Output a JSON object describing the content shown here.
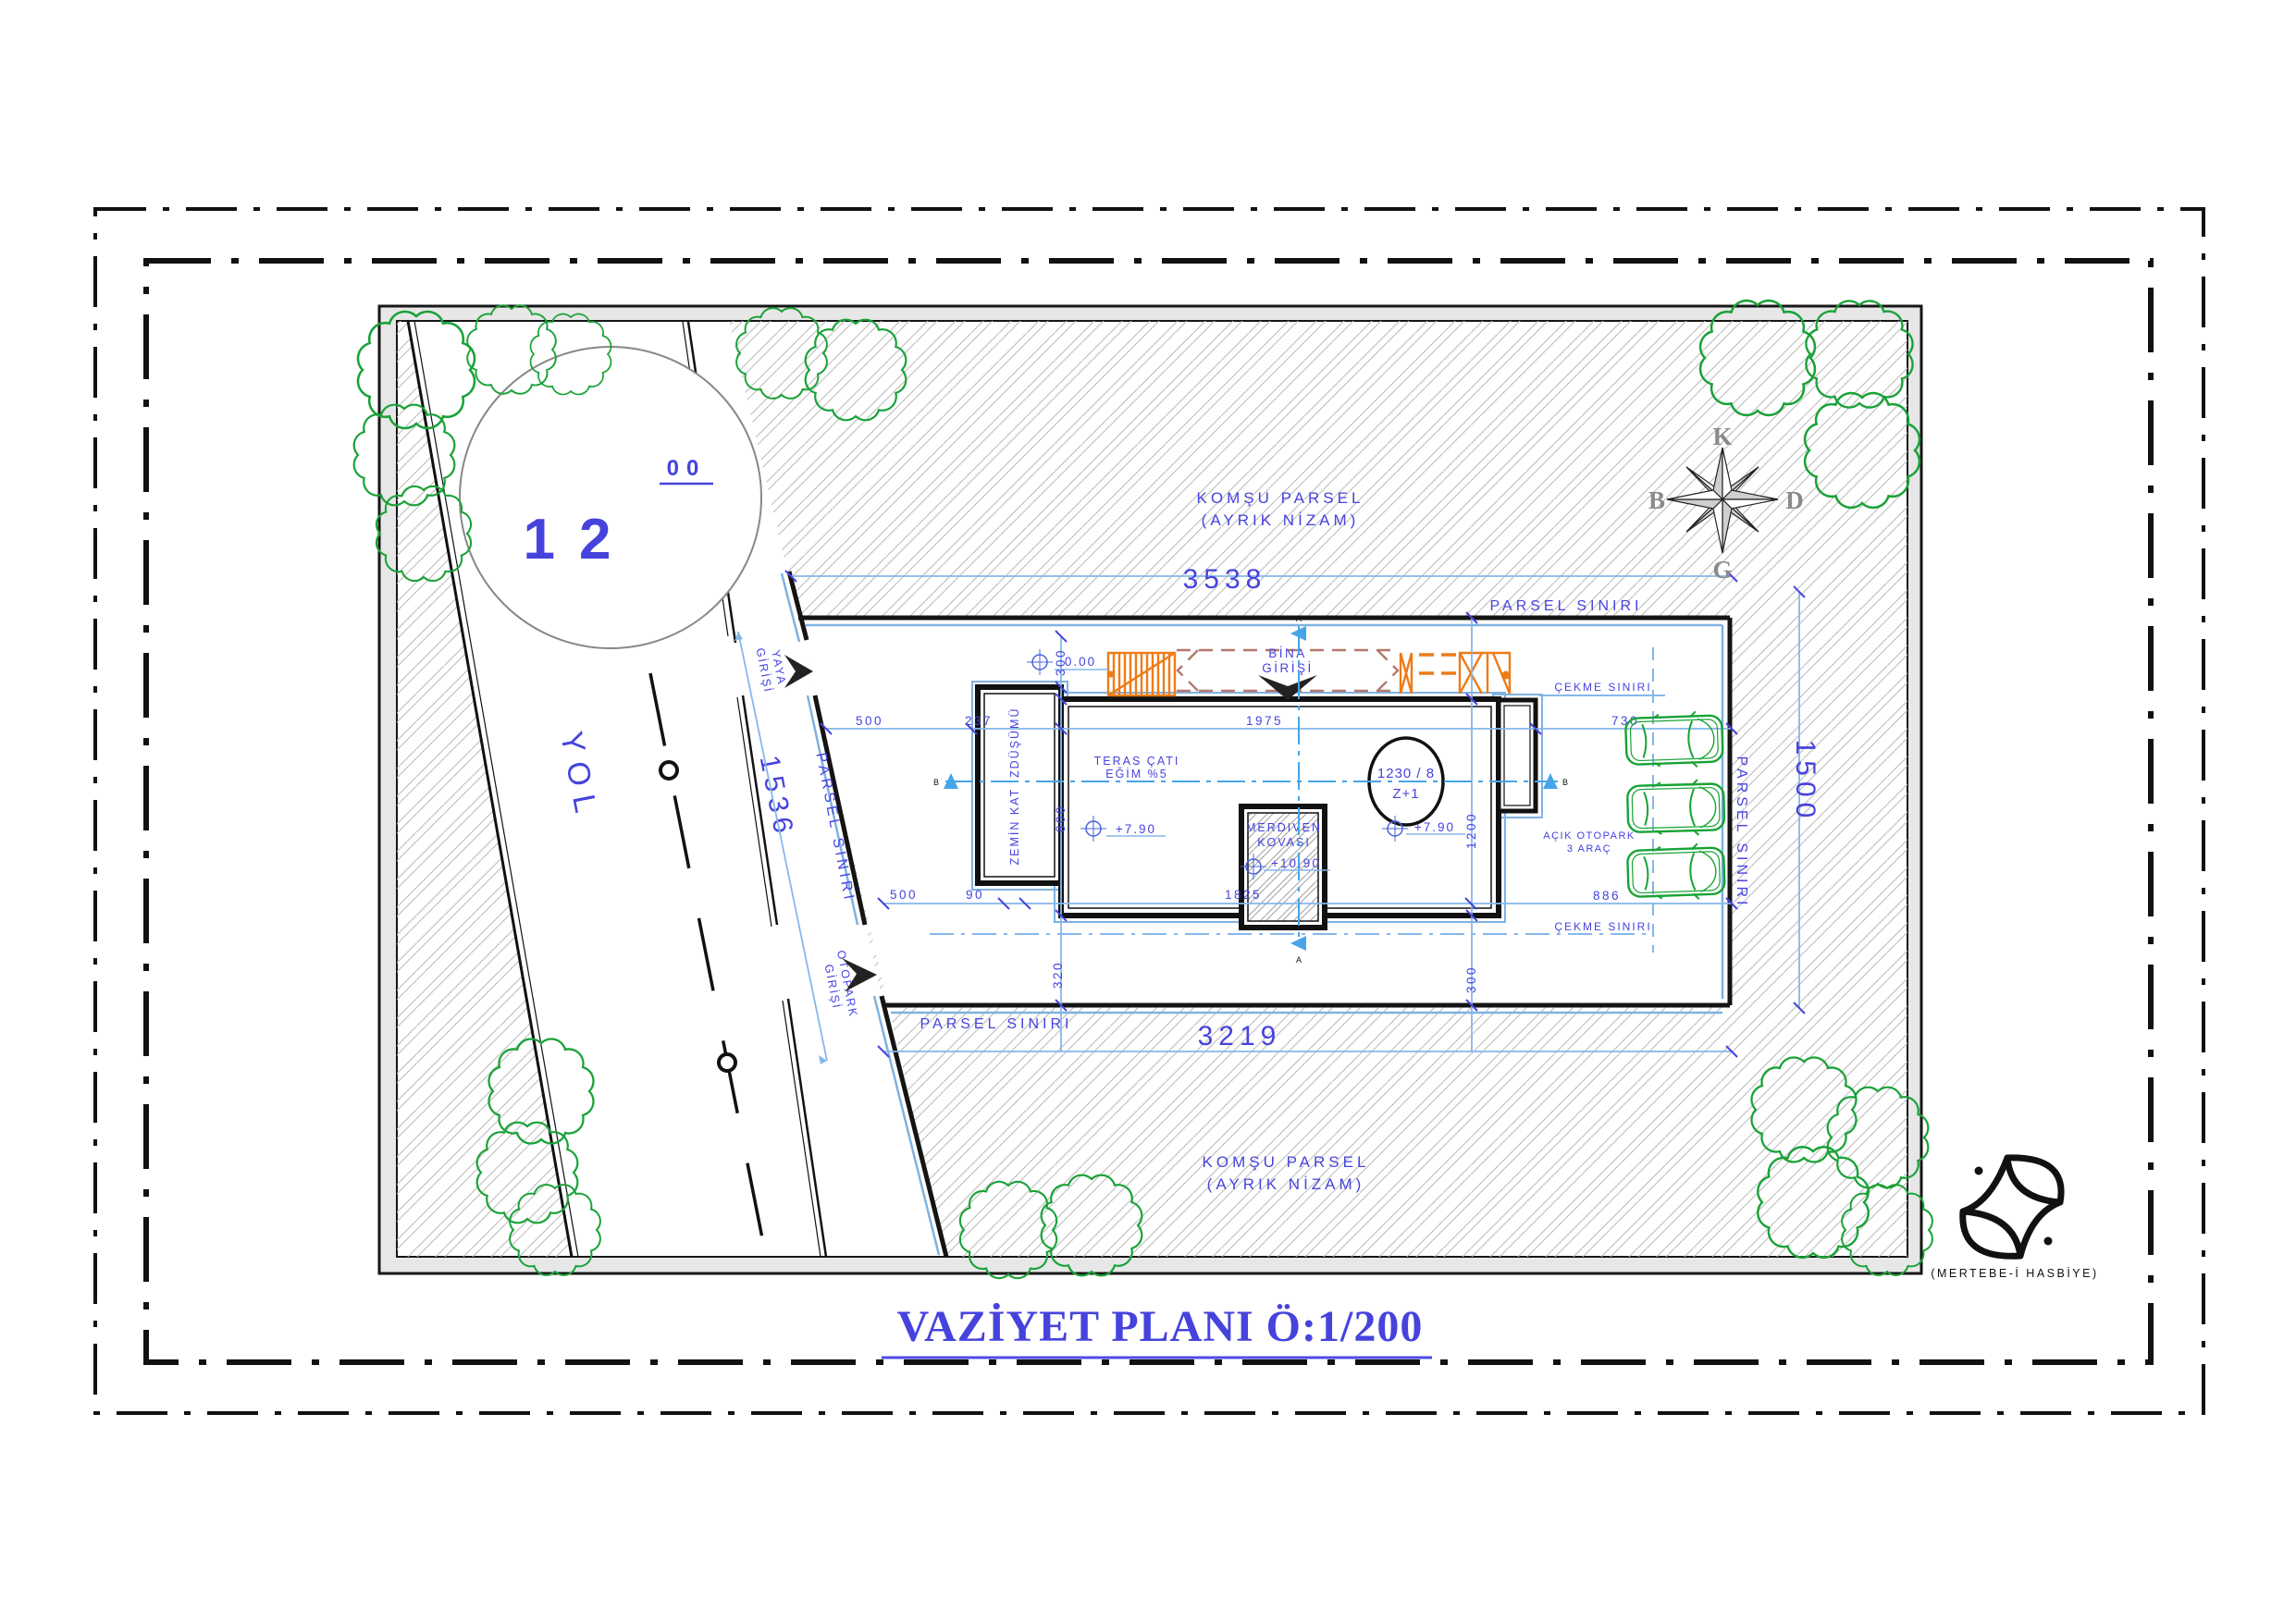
{
  "title": "VAZİYET PLANI Ö:1/200",
  "logo_text": "(MERTEBE-İ HASBİYE)",
  "compass": {
    "north": "K",
    "west": "B",
    "east": "D",
    "south": "G"
  },
  "road": {
    "name": "YOL",
    "number": "12",
    "number_sup": "00",
    "length": "1536"
  },
  "boundaries": {
    "parsel": "PARSEL SINIRI",
    "cekme": "ÇEKME SINIRI"
  },
  "neighbor": {
    "line1": "KOMŞU PARSEL",
    "line2": "(AYRIK NİZAM)"
  },
  "entrances": {
    "bina1": "BİNA",
    "bina2": "GİRİŞİ",
    "yaya1": "YAYA",
    "yaya2": "GİRİŞİ",
    "otopark1": "OTOPARK",
    "otopark2": "GİRİŞİ"
  },
  "building": {
    "teras1": "TERAS ÇATI",
    "teras2": "EĞİM %5",
    "zemin": "ZEMİN KAT İZDÜŞÜMÜ",
    "merdiven1": "MERDIVEN",
    "merdiven2": "KOVASI",
    "ada": "1230 / 8",
    "kat": "Z+1"
  },
  "parking": {
    "line1": "AÇIK OTOPARK",
    "line2": "3  ARAÇ"
  },
  "levels": {
    "zero": "0.00",
    "seven90": "+7.90",
    "ten90": "+10.90"
  },
  "dims": {
    "top": "3538",
    "bottom": "3219",
    "right": "1500",
    "w500a": "500",
    "w237": "237",
    "w1975": "1975",
    "w730": "730",
    "w500b": "500",
    "w90": "90",
    "w1825": "1825",
    "w886": "886",
    "h300a": "300",
    "h800": "800",
    "h320": "320",
    "h1200": "1200",
    "h300b": "300"
  },
  "sections": {
    "a": "A",
    "b": "B"
  },
  "colors": {
    "dim_text_blue": "#4643dd",
    "dim_line_blue": "#86b7ea",
    "marker_blue": "#45a5e8",
    "tree_green": "#1aa238",
    "car_green": "#17a335",
    "stair_orange": "#ee7c17",
    "canopy_brown": "#b5786c",
    "title_blue": "#4d4be6"
  }
}
